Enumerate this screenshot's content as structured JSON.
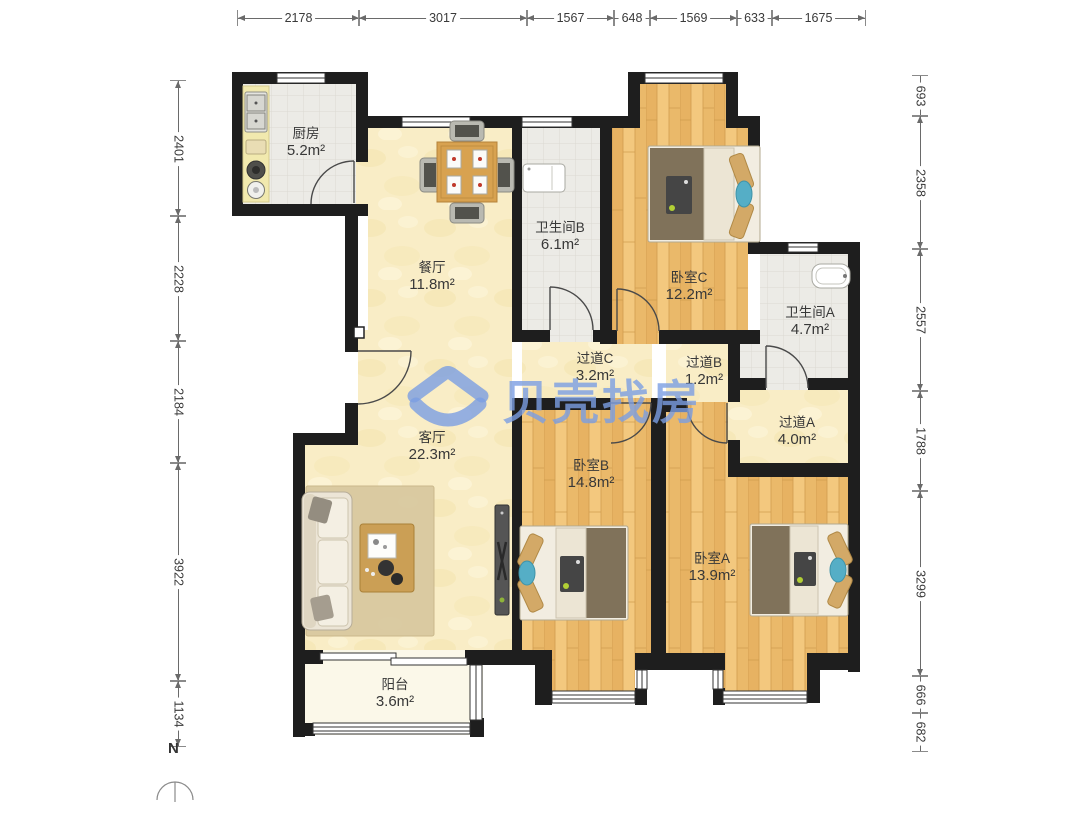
{
  "watermark": {
    "text": "贝壳找房",
    "color": "#7a9ee2"
  },
  "compass": {
    "label": "N"
  },
  "rooms": {
    "kitchen": {
      "name": "厨房",
      "area": "5.2m²"
    },
    "dining": {
      "name": "餐厅",
      "area": "11.8m²"
    },
    "bath_b": {
      "name": "卫生间B",
      "area": "6.1m²"
    },
    "bed_c": {
      "name": "卧室C",
      "area": "12.2m²"
    },
    "bath_a": {
      "name": "卫生间A",
      "area": "4.7m²"
    },
    "hall_c": {
      "name": "过道C",
      "area": "3.2m²"
    },
    "hall_b": {
      "name": "过道B",
      "area": "1.2m²"
    },
    "hall_a": {
      "name": "过道A",
      "area": "4.0m²"
    },
    "living": {
      "name": "客厅",
      "area": "22.3m²"
    },
    "bed_b": {
      "name": "卧室B",
      "area": "14.8m²"
    },
    "bed_a": {
      "name": "卧室A",
      "area": "13.9m²"
    },
    "balcony": {
      "name": "阳台",
      "area": "3.6m²"
    }
  },
  "dimensions": {
    "top": [
      {
        "value": "2178"
      },
      {
        "value": "3017"
      },
      {
        "value": "1567"
      },
      {
        "value": "648"
      },
      {
        "value": "1569"
      },
      {
        "value": "633"
      },
      {
        "value": "1675"
      }
    ],
    "left": [
      {
        "value": "2401"
      },
      {
        "value": "2228"
      },
      {
        "value": "2184"
      },
      {
        "value": "3922"
      },
      {
        "value": "1134"
      }
    ],
    "right": [
      {
        "value": "693"
      },
      {
        "value": "2358"
      },
      {
        "value": "2557"
      },
      {
        "value": "1788"
      },
      {
        "value": "3299"
      },
      {
        "value": "666"
      },
      {
        "value": "682"
      }
    ]
  },
  "colors": {
    "wall": "#1e1e1e",
    "wood_floor": "#eebd6f",
    "marble_floor": "#f9edc6",
    "tile_floor": "#ecebe6",
    "balcony_floor": "#fbf8e9"
  }
}
